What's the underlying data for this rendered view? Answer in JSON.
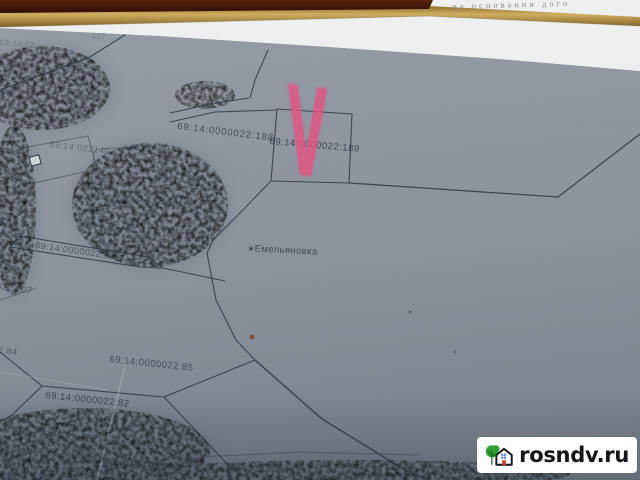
{
  "document_edge": {
    "text": "на основании  дого"
  },
  "map": {
    "settlement": {
      "star": "★",
      "name": "Емельяновка"
    },
    "marker": {
      "glyph": "V",
      "color": "#e25482"
    },
    "parcel_labels": [
      {
        "text": "69:14:0000022:188."
      },
      {
        "text": "69:14:0000022:189"
      },
      {
        "text": "69:14:022140:13"
      },
      {
        "text": "69:14:0221401:38"
      },
      {
        "text": "69:14:0000022:83"
      },
      {
        "text": "0022:107"
      },
      {
        "text": "022:84"
      },
      {
        "text": "69:14:0000022:85"
      },
      {
        "text": "69:14:0000022:82"
      },
      {
        "text": "69:14:0000022:1"
      },
      {
        "text": "69:14:02"
      },
      {
        "text": "107"
      }
    ]
  },
  "watermark": {
    "text": "rosndv.ru"
  },
  "colors": {
    "marker_pink": "#e25482",
    "map_base": "#9097a1",
    "boundary_line": "#26313f",
    "gold_strip": "#b8964a",
    "maroon_edge": "#4a1c0c",
    "paper": "#edf0ee",
    "badge_bg": "#ffffff",
    "tree_green": "#2f9e33",
    "window_blue": "#4a7ae0",
    "door_red": "#d23b33"
  }
}
